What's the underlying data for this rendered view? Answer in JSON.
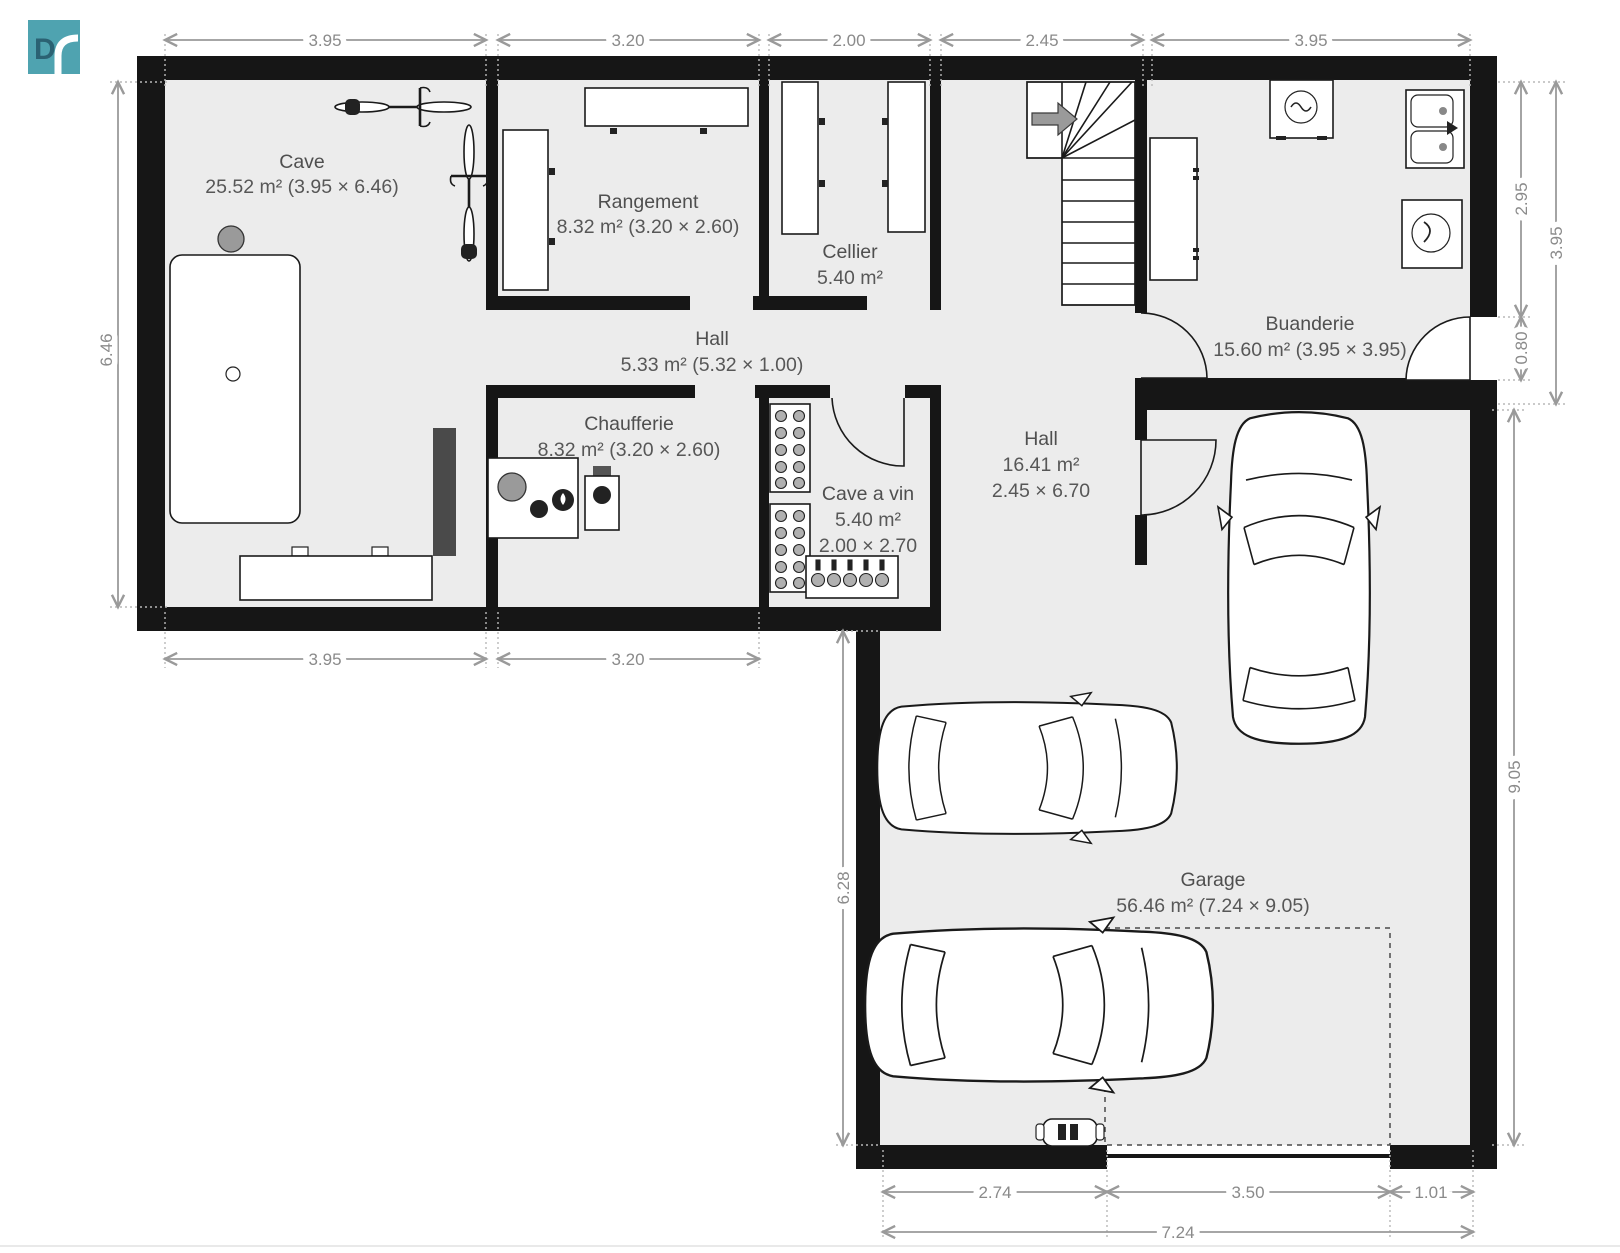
{
  "logo": {
    "letter": "D"
  },
  "rooms": [
    {
      "name": "Cave",
      "line2": "25.52 m² (3.95 × 6.46)"
    },
    {
      "name": "Rangement",
      "line2": "8.32 m² (3.20 × 2.60)"
    },
    {
      "name": "Cellier",
      "line2": "5.40 m²"
    },
    {
      "name": "Hall",
      "line2": "5.33 m² (5.32 × 1.00)"
    },
    {
      "name": "Chaufferie",
      "line2": "8.32 m² (3.20 × 2.60)"
    },
    {
      "name": "Cave a vin",
      "line2": "5.40 m²",
      "line3": "2.00 × 2.70"
    },
    {
      "name": "Hall",
      "line2": "16.41 m²",
      "line3": "2.45 × 6.70"
    },
    {
      "name": "Buanderie",
      "line2": "15.60 m² (3.95 × 3.95)"
    },
    {
      "name": "Garage",
      "line2": "56.46 m² (7.24 × 9.05)"
    }
  ],
  "dims": {
    "top": [
      "3.95",
      "3.20",
      "2.00",
      "2.45",
      "3.95"
    ],
    "left": "6.46",
    "bottom_left": [
      "3.95",
      "3.20"
    ],
    "right_inner": "2.95",
    "right_door": "0.80",
    "right_outer": "3.95",
    "right_garage": "9.05",
    "garage_left": "6.28",
    "garage_bottom": [
      "2.74",
      "3.50",
      "1.01"
    ],
    "garage_total": "7.24"
  },
  "colors": {
    "wall": "#161616",
    "floor": "#ECECEC",
    "dimension": "#8a8a8a",
    "label": "#4f4f4f",
    "logo": "#4FA3B0"
  }
}
